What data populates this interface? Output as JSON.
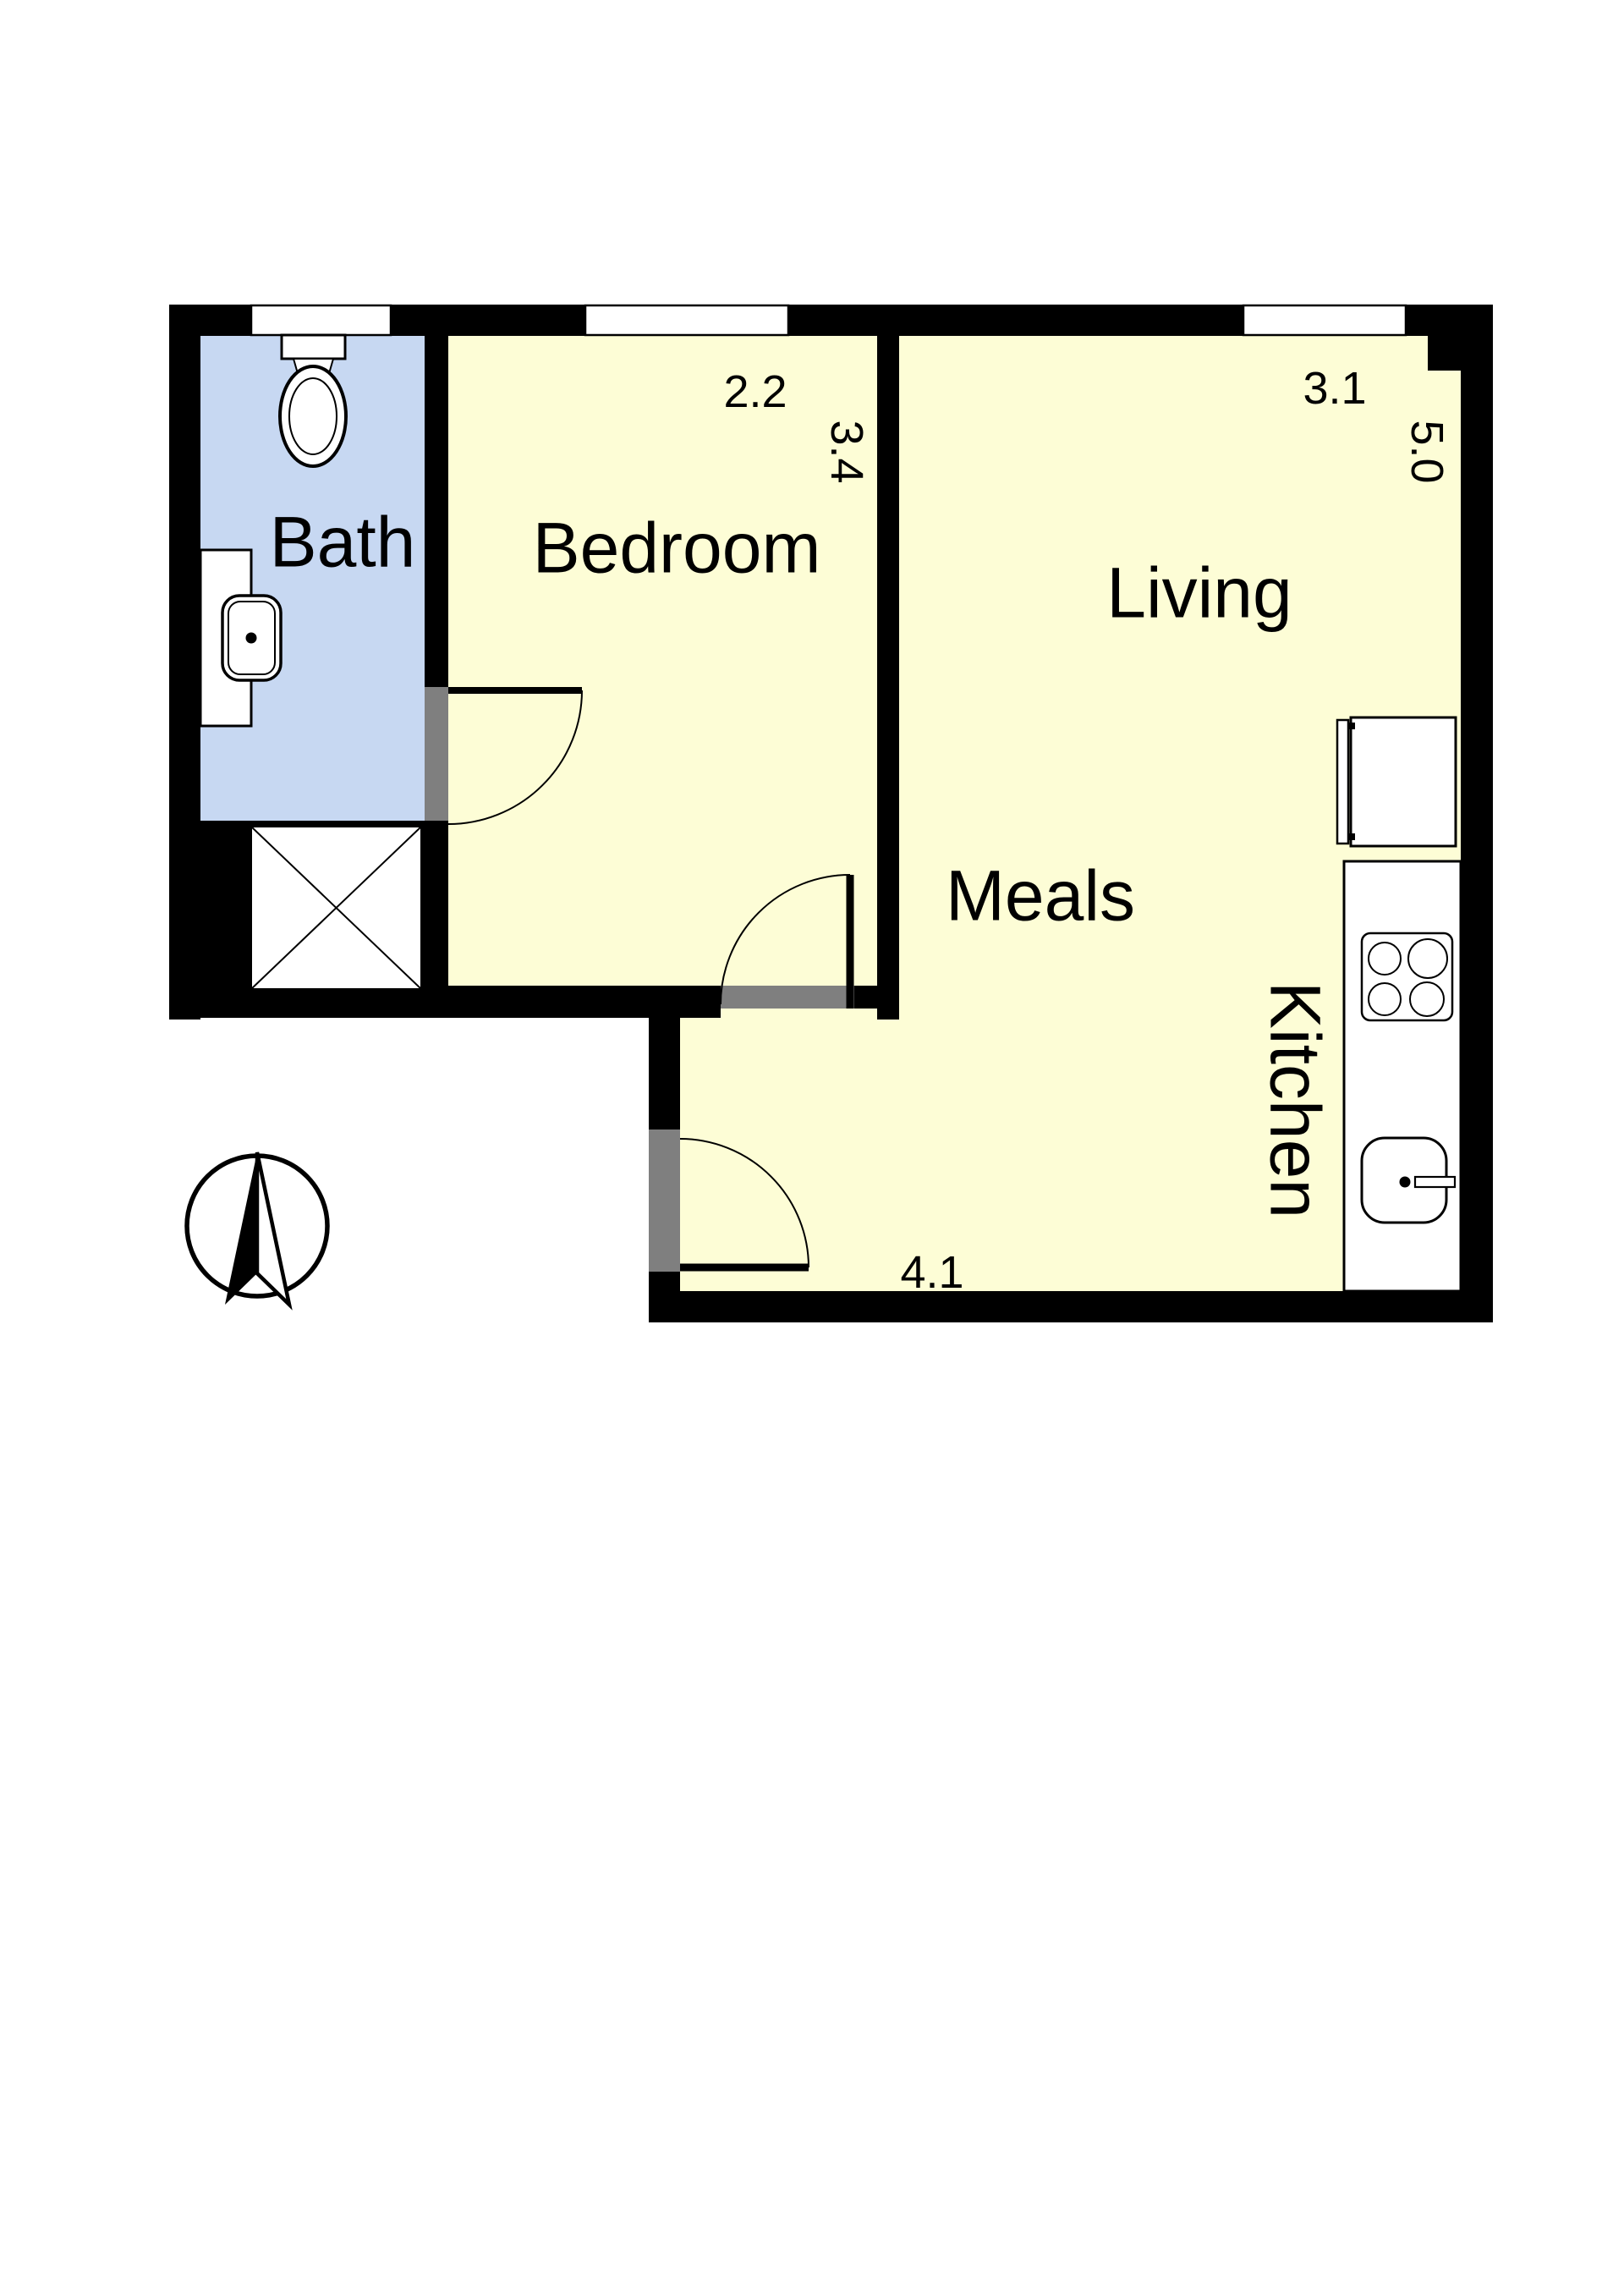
{
  "document": {
    "type": "apartment floor plan"
  },
  "rooms": {
    "bath": {
      "label": "Bath"
    },
    "bedroom": {
      "label": "Bedroom",
      "width_m": "2.2",
      "depth_m": "3.4"
    },
    "living": {
      "label": "Living",
      "width_m": "3.1",
      "depth_m": "5.0"
    },
    "meals": {
      "label": "Meals",
      "width_m": "4.1"
    },
    "kitchen": {
      "label": "Kitchen"
    }
  },
  "colors": {
    "wall": "#000000",
    "room_fill": "#FDFDD6",
    "bath_fill": "#C7D8F2",
    "door_opening": "#7F7F7F",
    "background": "#FFFFFF"
  }
}
